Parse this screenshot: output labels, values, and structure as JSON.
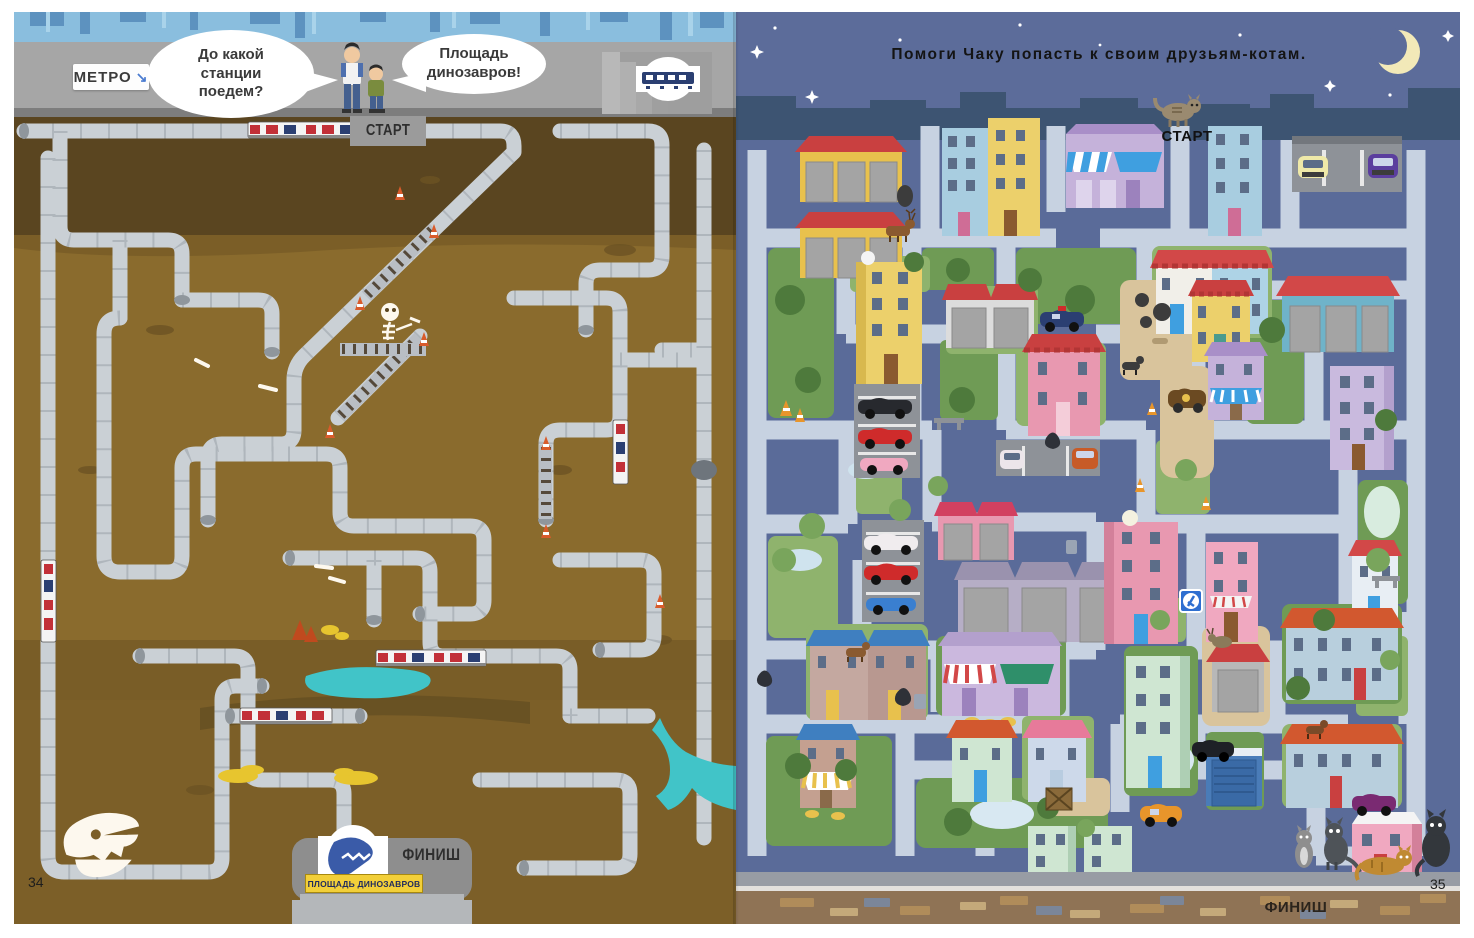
{
  "left_page": {
    "page_number": "34",
    "metro_sign_label": "МЕТРО",
    "metro_arrow_glyph": "↘",
    "speech_father": "До какой станции поедем?",
    "speech_child": "Площадь динозавров!",
    "start_label": "Старт",
    "finish_label": "Финиш",
    "finish_station_sign": "Площадь динозавров",
    "colors": {
      "sky": "#8abede",
      "sky_silhouette": "#5d92bf",
      "platform": "#a6a6a6",
      "soil_dark": "#5a4520",
      "soil_mid": "#8a6b2d",
      "soil_low": "#7c5f28",
      "tunnel": "#cad0d5",
      "water": "#41c4c8",
      "gold": "#e7c52f",
      "station_box": "#8e8e8e",
      "sign_yellow": "#f2cf39",
      "dino_logo_blue": "#3a5ba8",
      "train_red": "#c23038",
      "cone_orange": "#d95b2b"
    },
    "icons": [
      "metro-arrow-icon",
      "train-icon",
      "escalator-icon",
      "rail-track-icon",
      "traffic-cone-icon",
      "bone-icon",
      "skeleton-icon",
      "fossil-skull-icon",
      "dino-station-logo-icon",
      "stairs-icon",
      "metro-entrance-sign-icon",
      "water-puddle-icon",
      "waterfall-icon",
      "treasure-icon",
      "crystal-icon",
      "father-figure",
      "son-figure"
    ]
  },
  "right_page": {
    "page_number": "35",
    "instruction": "Помоги Чаку попасть к своим друзьям-котам.",
    "start_label": "Старт",
    "finish_label": "Финиш",
    "colors": {
      "night_sky": "#5c6c9a",
      "skyline": "#3d5472",
      "city_bg": "#5a6b99",
      "street": "#c7d2e1",
      "lawn_dark": "#6f9b55",
      "lawn_light": "#8fb36d",
      "dirt": "#d9c49c",
      "sidewalk": "#989ca4",
      "ground": "#8f7355",
      "moon": "#f2e9b8",
      "garage_yellow": "#e8c14d",
      "roof_red": "#c94040",
      "house_pink": "#e898b0",
      "apt_blue": "#a8cde0",
      "sign_blue": "#2f6fd0"
    },
    "icons": [
      "moon-icon",
      "star-icon",
      "cat-icon",
      "dog-icon",
      "deer-icon",
      "goat-icon",
      "car-icon",
      "tree-icon",
      "pond-icon",
      "traffic-cone-icon",
      "trash-bag-icon",
      "trash-can-icon",
      "bench-icon",
      "awning-icon",
      "garage-door-icon",
      "parking-sign-icon",
      "crate-icon"
    ]
  }
}
